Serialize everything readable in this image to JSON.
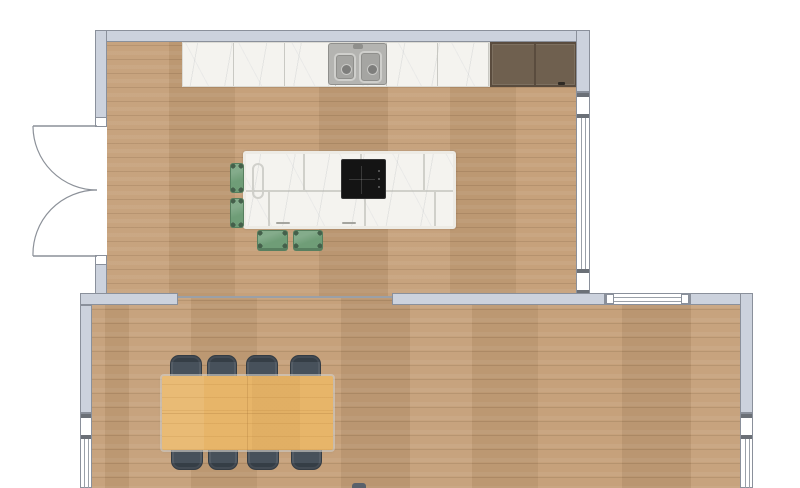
{
  "scene": {
    "type": "floor-plan",
    "rooms": [
      {
        "id": "kitchen",
        "floor_material": "light oak plank",
        "contents": [
          "marble countertop",
          "double-basin sink",
          "tall cabinet",
          "kitchen island with cooktop",
          "4 bar stools"
        ]
      },
      {
        "id": "dining-room",
        "floor_material": "light oak plank",
        "contents": [
          "dining table",
          "8 dining chairs"
        ]
      }
    ],
    "openings": [
      {
        "id": "double-door",
        "type": "double swing door",
        "wall": "kitchen-left"
      },
      {
        "id": "kitchen-right-window",
        "type": "window",
        "wall": "kitchen-right"
      },
      {
        "id": "dining-top-window",
        "type": "window",
        "wall": "dining-top"
      },
      {
        "id": "dining-left-window",
        "type": "window",
        "wall": "dining-left"
      },
      {
        "id": "dining-right-window",
        "type": "window",
        "wall": "dining-right"
      }
    ],
    "furniture_counts": {
      "bar_stools": 4,
      "dining_chairs": 8,
      "sinks": 1,
      "cooktops": 1
    }
  },
  "colors": {
    "wall": "#ccd2dd",
    "wall_outline": "#8a909b",
    "floor_wood": "#c49e77",
    "marble": "#f4f3ef",
    "cabinet_brown": "#6f604f",
    "stool_green": "#6f9d77",
    "table_oak": "#e7b569",
    "chair_slate": "#47515b",
    "cooktop_black": "#141414",
    "sink_steel": "#b4b4b1",
    "window_mullion": "#6b7077",
    "cutoff_gray": "#59616b"
  }
}
